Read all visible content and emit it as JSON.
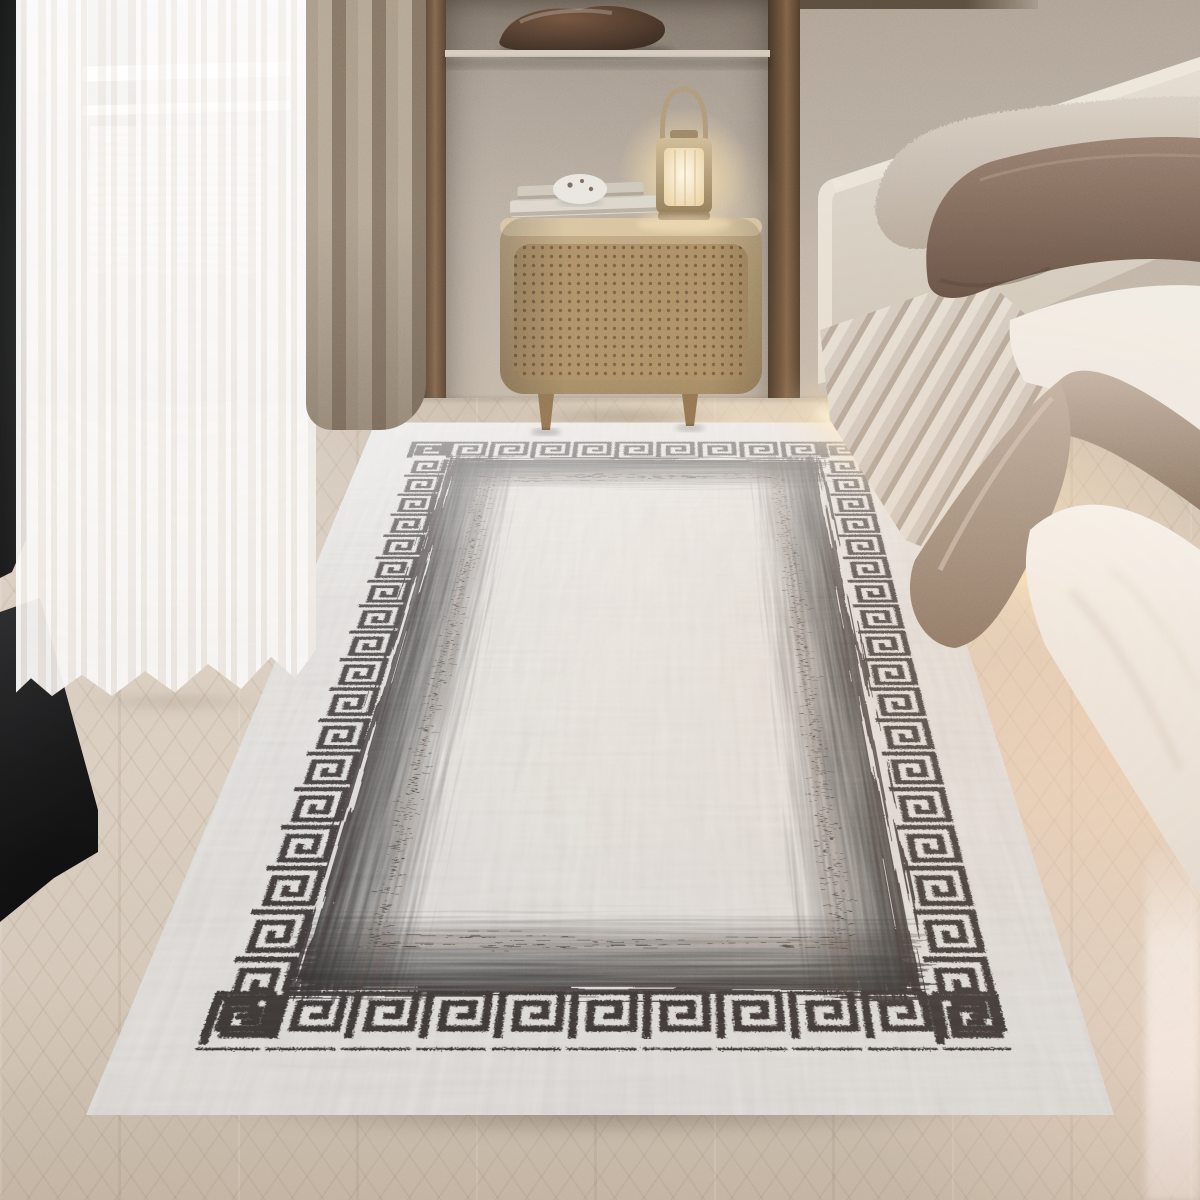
{
  "meta": {
    "title": "Bedroom photo: grey distressed area rug with black Greek-key border beside an upholstered bed",
    "type": "photograph",
    "no_visible_text": true
  },
  "objects": {
    "window_frame": {
      "label": "Dark floor-to-ceiling window frame and sill"
    },
    "window_bars": {
      "label": "White window frame bars behind sheer"
    },
    "blind": {
      "label": "Beige slatted blind glimpse"
    },
    "sheer_curtain": {
      "label": "White sheer curtain"
    },
    "brown_curtain": {
      "label": "Taupe curtain panel"
    },
    "wall": {
      "label": "Textured plaster wall"
    },
    "niche": {
      "label": "Recessed wall niche with shelf"
    },
    "bowl": {
      "label": "Dark carved-wood decorative bowl"
    },
    "shelf": {
      "label": "Niche shelf board"
    },
    "trim": {
      "label": "Dark walnut wall trim strips"
    },
    "nightstand": {
      "label": "Rattan cane nightstand with wooden legs"
    },
    "books": {
      "label": "Two stacked books"
    },
    "pebble": {
      "label": "White pebble-shaped ornament"
    },
    "lantern": {
      "label": "Glowing metal-and-glass lantern lamp"
    },
    "headboard": {
      "label": "Light upholstered headboard"
    },
    "pillow_light": {
      "label": "Beige textured pillow"
    },
    "pillow_dark": {
      "label": "Mauve-brown satin pillow"
    },
    "mattress": {
      "label": "Striped upholstered bed base"
    },
    "sheet": {
      "label": "Draped greige satin sheet"
    },
    "duvet": {
      "label": "White duvet"
    },
    "underbed_light": {
      "label": "Warm under-bed light glow on floor"
    },
    "floor": {
      "label": "Light herringbone wood floor"
    },
    "rug": {
      "label": "Grey distressed rug, black Greek-key meander border, dark inner halo band and thin dashed inner frame"
    }
  },
  "palette": {
    "wall_hi": "#bcb1a4",
    "wall_lo": "#a89c8f",
    "niche_hi": "#b6aa9b",
    "trim_hi": "#6b4f36",
    "frame_dark": "#131416",
    "sheer_hi": "#fdfbf9",
    "sheer_lo": "#f0eae4",
    "curtain_hi": "#a4947f",
    "curtain_lo": "#7d6c5a",
    "floor_hi": "#d9cdbe",
    "floor_lo": "#c8b9a7",
    "glow": "#ffe4b8",
    "wood_hi": "#c9ae83",
    "wood_lo": "#97794f",
    "cane_dot": "#4a3520",
    "shelf": "#d3c8b9",
    "bowl_hi": "#6b4a33",
    "bowl_lo": "#271a12",
    "headboard_hi": "#e3dccf",
    "headboard_lo": "#cbc3b5",
    "pillow_light_hi": "#d8cec1",
    "pillow_light_lo": "#b5a89a",
    "pillow_dark_hi": "#957c6c",
    "pillow_dark_lo": "#5e4a3d",
    "stripe_a": "#d3cabf",
    "stripe_b": "#b4a798",
    "sheet_hi": "#c2b1a2",
    "sheet_lo": "#83705f",
    "duvet_hi": "#faf8f4",
    "duvet_lo": "#e8e1d7",
    "rug_base": "#c8c5c0",
    "rug_key": "#1b1815",
    "rug_smudge": "#141110",
    "rug_line": "#2e2a26",
    "blind_a": "#d9cec0",
    "blind_b": "#c2b4a3",
    "bar_white": "#f6f3ee"
  }
}
